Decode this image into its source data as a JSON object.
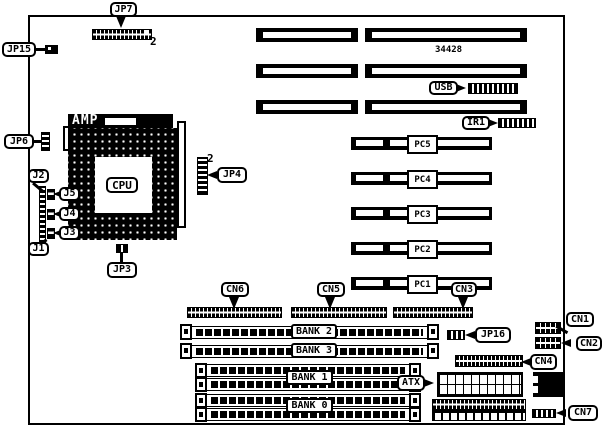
{
  "diagram": {
    "part_number": "34428",
    "pin_marker": "2"
  },
  "callouts": {
    "jp7": "JP7",
    "jp15": "JP15",
    "jp6": "JP6",
    "jp4": "JP4",
    "jp3": "JP3",
    "jp16": "JP16",
    "j1": "J1",
    "j2": "J2",
    "j3": "J3",
    "j4": "J4",
    "j5": "J5",
    "cn1": "CN1",
    "cn2": "CN2",
    "cn3": "CN3",
    "cn4": "CN4",
    "cn5": "CN5",
    "cn6": "CN6",
    "cn7": "CN7",
    "usb": "USB",
    "ir1": "IR1",
    "atx": "ATX"
  },
  "chips": {
    "cpu": "CPU",
    "amp": "AMP"
  },
  "slots": {
    "pci": [
      "PC5",
      "PC4",
      "PC3",
      "PC2",
      "PC1"
    ],
    "memory_banks": [
      "BANK 2",
      "BANK 3",
      "BANK 1",
      "BANK 0"
    ]
  }
}
